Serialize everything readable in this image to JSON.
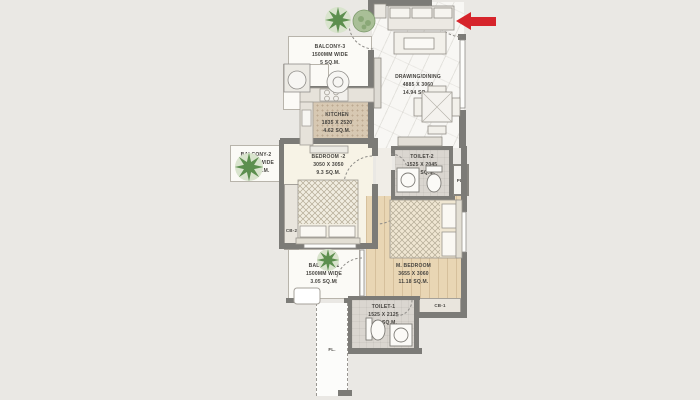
{
  "plan_title": "2BHK apartment floor plan",
  "rooms": {
    "drawing_dining": {
      "name": "DRAWING/DINING",
      "dims": "4885 X 3060",
      "area": "14.94 SQ.M."
    },
    "kitchen": {
      "name": "KITCHEN",
      "dims": "1835 X 2520",
      "area": "4.62 SQ.M."
    },
    "bedroom_2": {
      "name": "BEDROOM -2",
      "dims": "3050 X 3050",
      "area": "9.3 SQ.M."
    },
    "master_bedroom": {
      "name": "M. BEDROOM",
      "dims": "3655 X 3060",
      "area": "11.18 SQ.M."
    },
    "toilet_2": {
      "name": "TOILET-2",
      "dims": "1525 X 2045",
      "area": "3.11 SQ.M."
    },
    "toilet_1": {
      "name": "TOILET-1",
      "dims": "1525 X 2125",
      "area": "3.24 SQ.M."
    },
    "balcony_3": {
      "name": "BALCONY-3",
      "size": "1500MM WIDE",
      "area": "5 SQ.M."
    },
    "balcony_2": {
      "name": "BALCONY-2",
      "size": "1500MM WIDE",
      "area": "2.78 SQ.M."
    },
    "balcony_1": {
      "name": "BALCONY-1",
      "size": "1500MM WIDE",
      "area": "3.05 SQ.M."
    }
  },
  "fixtures": {
    "cupboard_1": "CB-1",
    "cupboard_2": "CB-2",
    "plumbing_shaft": "PL.",
    "ledge": "FL."
  },
  "colors": {
    "entry_arrow": "#d6242b",
    "wall": "#7c7b77",
    "background": "#eae8e4"
  }
}
